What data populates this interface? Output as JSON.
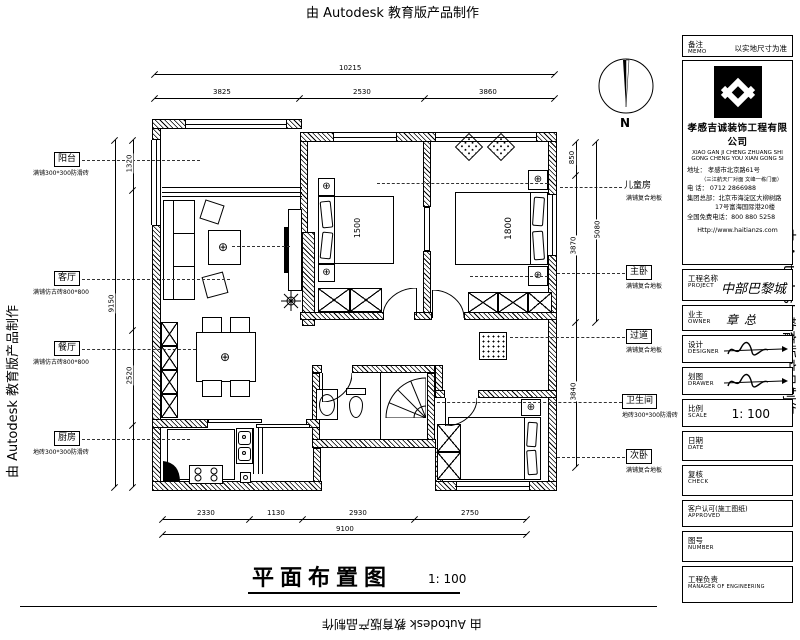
{
  "watermark": {
    "text": "由 Autodesk 教育版产品制作"
  },
  "sheet": {
    "title": "平面布置图",
    "title_scale": "1: 100",
    "compass_n": "N"
  },
  "symbols": {
    "lamp": "⊕"
  },
  "beds": {
    "master": "1800",
    "children": "1500"
  },
  "rooms": [
    {
      "name": "阳台",
      "finish": "满铺300*300防滑砖"
    },
    {
      "name": "客厅",
      "finish": "满铺仿古砖800*800"
    },
    {
      "name": "餐厅",
      "finish": "满铺仿古砖800*800"
    },
    {
      "name": "厨房",
      "finish": "地砖300*300防滑砖"
    },
    {
      "name": "儿童房",
      "finish": "满铺复合地板"
    },
    {
      "name": "主卧",
      "finish": "满铺复合地板"
    },
    {
      "name": "过道",
      "finish": "满铺复合地板"
    },
    {
      "name": "卫生间",
      "finish": "地砖300*300防滑砖"
    },
    {
      "name": "次卧",
      "finish": "满铺复合地板"
    }
  ],
  "dims": {
    "top_total": "10215",
    "top_segs": [
      "3825",
      "2530",
      "3860"
    ],
    "bottom_segs": [
      "2330",
      "1130",
      "2930",
      "2750"
    ],
    "bottom_total": "9100",
    "left_segs": [
      "1320",
      "2520"
    ],
    "left_total": "9150",
    "right_segs": [
      "850",
      "3870",
      "3840"
    ],
    "right_total": "5080"
  },
  "titleblock": {
    "memo_cn": "备注",
    "memo_en": "MEMO",
    "memo_value": "以实地尺寸为准",
    "company_cn": "孝感吉诚装饰工程有限公司",
    "company_py1": "XIAO GAN JI CHENG ZHUANG SHI",
    "company_py2": "GONG CHENG YOU XIAN GONG SI",
    "address_line": "地址：  孝感市北京路61号",
    "address_note": "（三江航天厂对面 文峰一栋门面）",
    "phone_line": "电  话：  0712 2866988",
    "hq_line1": "集团总部：北京市海淀区大柳树路",
    "hq_line2": "17号富海国际港20楼",
    "hotline_line": "全国免费电话：800 880 5258",
    "website": "Http://www.haitianzs.com",
    "project_cn": "工程名称",
    "project_en": "PROJECT",
    "project_value": "中部巴黎城",
    "owner_cn": "业主",
    "owner_en": "OWNER",
    "owner_value": "章总",
    "designer_cn": "设计",
    "designer_en": "DESIGNER",
    "drawer_cn": "划图",
    "drawer_en": "DRAWER",
    "scale_cn": "比例",
    "scale_en": "SCALE",
    "scale_value": "1:  100",
    "date_cn": "日期",
    "date_en": "DATE",
    "check_cn": "复核",
    "check_en": "CHECK",
    "approved_cn": "客户认可(施工图纸)",
    "approved_en": "APPROVED",
    "number_cn": "图号",
    "number_en": "NUMBER",
    "manager_cn": "工程负责",
    "manager_en": "MANAGER OF ENGINEERING"
  }
}
